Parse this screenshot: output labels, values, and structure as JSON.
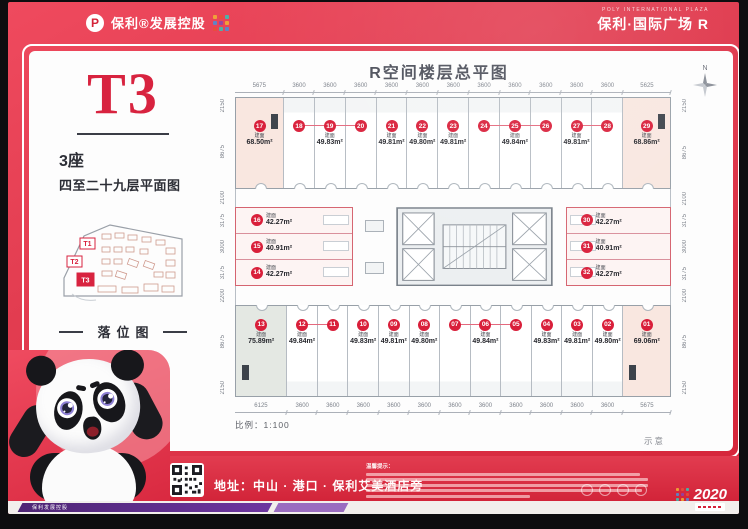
{
  "header": {
    "brand_left": "保利®发展控股",
    "brand_right_top": "POLY INTERNATIONAL PLAZA",
    "brand_right": "保利·国际广场 R"
  },
  "left_panel": {
    "tower": "T3",
    "block": "3座",
    "subtitle": "四至二十九层平面图",
    "map_caption": "落位图",
    "map_t1": "T1",
    "map_t2": "T2",
    "map_t3": "T3"
  },
  "plan": {
    "title": "R空间楼层总平图",
    "north": "N",
    "scale_label": "比例：1:100",
    "note": "示意",
    "area_prefix": "建面",
    "dims_top": [
      "5675",
      "3600",
      "3600",
      "3600",
      "3600",
      "3600",
      "3600",
      "3600",
      "3600",
      "3600",
      "3600",
      "3600",
      "5625"
    ],
    "dims_bottom": [
      "6125",
      "3600",
      "3600",
      "3600",
      "3600",
      "3600",
      "3600",
      "3600",
      "3600",
      "3600",
      "3600",
      "3600",
      "5675"
    ],
    "dims_left": [
      "2150",
      "8675",
      "2100",
      "3175",
      "3000",
      "3175",
      "2200",
      "8675",
      "2150"
    ],
    "dims_right": [
      "2150",
      "8675",
      "2100",
      "3175",
      "3000",
      "3175",
      "2100",
      "8675",
      "2150"
    ],
    "top_row": [
      {
        "no": "17",
        "area": "68.50m²",
        "hl": "pink"
      },
      {
        "no": "18",
        "grp": "s"
      },
      {
        "no": "19",
        "area": "49.83m²",
        "grp": "m"
      },
      {
        "no": "20",
        "grp": "e"
      },
      {
        "no": "21",
        "area": "49.81m²"
      },
      {
        "no": "22",
        "area": "49.80m²"
      },
      {
        "no": "23",
        "area": "49.81m²"
      },
      {
        "no": "24",
        "grp": "s"
      },
      {
        "no": "25",
        "area": "49.84m²",
        "grp": "m"
      },
      {
        "no": "26",
        "grp": "e"
      },
      {
        "no": "27",
        "area": "49.81m²",
        "grp": "s"
      },
      {
        "no": "28",
        "grp": "e"
      },
      {
        "no": "29",
        "area": "68.86m²",
        "hl": "pink"
      }
    ],
    "mid_left": [
      {
        "no": "16",
        "area": "42.27m²"
      },
      {
        "no": "15",
        "area": "40.91m²"
      },
      {
        "no": "14",
        "area": "42.27m²"
      }
    ],
    "mid_right": [
      {
        "no": "30",
        "area": "42.27m²"
      },
      {
        "no": "31",
        "area": "40.91m²"
      },
      {
        "no": "32",
        "area": "42.27m²"
      }
    ],
    "bottom_row": [
      {
        "no": "13",
        "area": "75.89m²",
        "hl": "grey"
      },
      {
        "no": "12",
        "area": "49.84m²",
        "grp": "s"
      },
      {
        "no": "11",
        "grp": "e"
      },
      {
        "no": "10",
        "area": "49.83m²"
      },
      {
        "no": "09",
        "area": "49.81m²"
      },
      {
        "no": "08",
        "area": "49.80m²"
      },
      {
        "no": "07",
        "grp": "s"
      },
      {
        "no": "06",
        "area": "49.84m²",
        "grp": "m"
      },
      {
        "no": "05",
        "grp": "e"
      },
      {
        "no": "04",
        "area": "49.83m²"
      },
      {
        "no": "03",
        "area": "49.81m²"
      },
      {
        "no": "02",
        "area": "49.80m²"
      },
      {
        "no": "01",
        "area": "69.06m²",
        "hl": "pink"
      }
    ]
  },
  "footer": {
    "address": "地址：中山 · 港口 · 保利艾美酒店旁",
    "disclaimer_title": "温馨提示：",
    "badge_year": "2020",
    "ribbon_text": "保利发展控股"
  },
  "colors": {
    "poster_red": "#e23c50",
    "accent_red": "#d91f3a",
    "highlight_pink": "#f9e7e0",
    "highlight_grey": "#e4e8e3",
    "purple_ribbon": "#5c2c83"
  }
}
